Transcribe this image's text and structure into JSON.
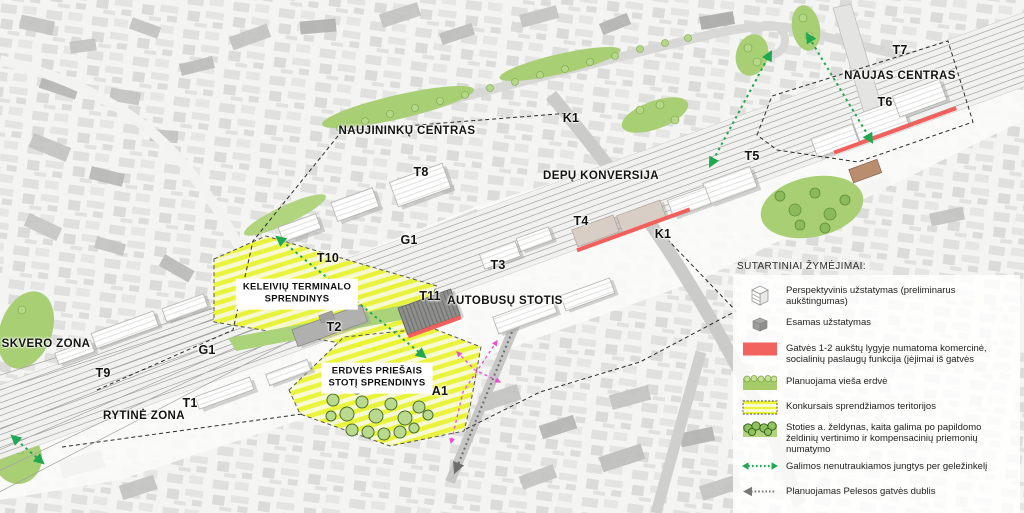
{
  "map": {
    "labels": [
      {
        "text": "NAUJININKŲ CENTRAS"
      },
      {
        "text": "K1"
      },
      {
        "text": "DEPŲ KONVERSIJA"
      },
      {
        "text": "T8"
      },
      {
        "text": "T4"
      },
      {
        "text": "G1"
      },
      {
        "text": "K1"
      },
      {
        "text": "T7"
      },
      {
        "text": "NAUJAS CENTRAS"
      },
      {
        "text": "T6"
      },
      {
        "text": "T5"
      },
      {
        "text": "T10"
      },
      {
        "text": "T2"
      },
      {
        "text": "T11"
      },
      {
        "text": "AUTOBUSŲ STOTIS"
      },
      {
        "text": "T3"
      },
      {
        "text": "A1"
      },
      {
        "text": "SKVERO ZONA"
      },
      {
        "text": "T9"
      },
      {
        "text": "G1"
      },
      {
        "text": "T1"
      },
      {
        "text": "RYTINĖ ZONA"
      }
    ],
    "zone_boxes": [
      {
        "line1": "KELEIVIŲ TERMINALO",
        "line2": "SPRENDINYS"
      },
      {
        "line1": "ERDVĖS PRIEŠAIS",
        "line2": "STOTĮ SPRENDINYS"
      }
    ]
  },
  "legend": {
    "title": "SUTARTINIAI ŽYMĖJIMAI:",
    "items": [
      {
        "icon": "perspective-building-icon",
        "label": "Perspektyvinis užstatymas (preliminarus aukštingumas)"
      },
      {
        "icon": "existing-building-icon",
        "label": "Esamas užstatymas"
      },
      {
        "icon": "commercial-frontage-swatch",
        "label": "Gatvės 1-2 aukštų lygyje numatoma komercinė, socialinių paslaugų funkcija (įėjimai iš gatvės"
      },
      {
        "icon": "public-space-swatch",
        "label": "Planuojama vieša erdvė"
      },
      {
        "icon": "competition-area-swatch",
        "label": "Konkursais sprendžiamos teritorijos"
      },
      {
        "icon": "station-greenery-icon",
        "label": "Stoties a. želdynas, kaita galima po papildomo želdinių vertinimo ir kompensacinių priemonių numatymo"
      },
      {
        "icon": "rail-connection-arrow-icon",
        "label": "Galimos nenutraukiamos jungtys per geležinkelį"
      },
      {
        "icon": "pelesos-street-arrow-icon",
        "label": "Planuojamas Pelesos gatvės dublis"
      },
      {
        "icon": "pedestrian-flow-line-icon",
        "label": "Pagrindiniai pėsčiųjų srautai erdvėje priešais planuojamą mobilumo mazgą"
      }
    ]
  },
  "colors": {
    "competition_yellow": "#eaf42f",
    "public_green": "#a8cf73",
    "commercial_red": "#f25f5c",
    "connection_green": "#1fa84f",
    "pedestrian_magenta": "#e84fd0",
    "existing_gray": "#c2c2c0"
  }
}
